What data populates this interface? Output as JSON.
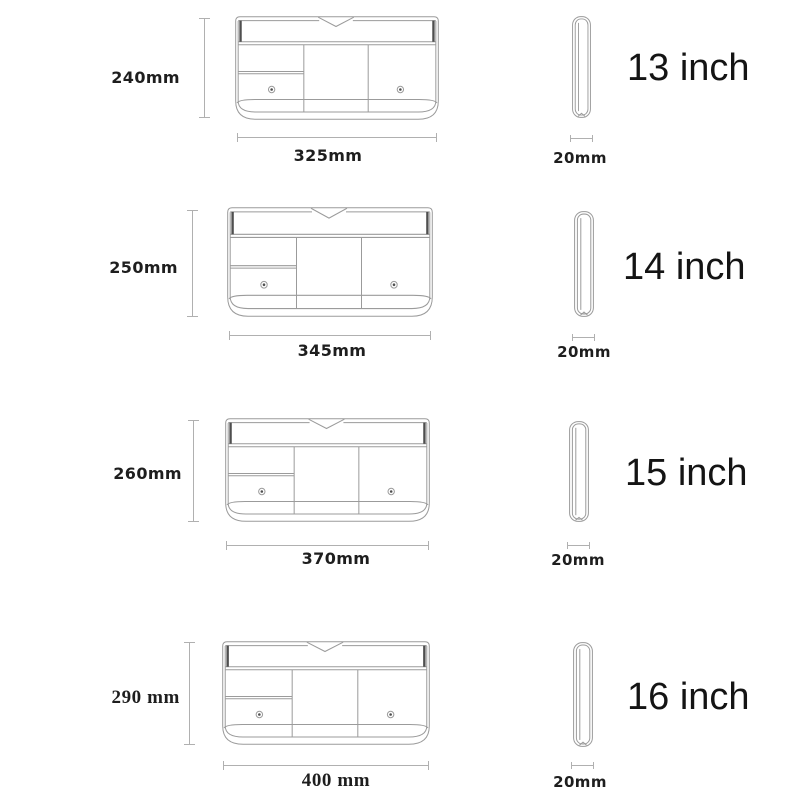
{
  "colors": {
    "background": "#ffffff",
    "ink": "#1e1e1e",
    "dim-line": "#b0b0b0",
    "drawing-line": "#9b9b9b",
    "drawing-dark": "#4f4f4f"
  },
  "rows": [
    {
      "size_label": "13 inch",
      "height_label": "240mm",
      "width_label": "325mm",
      "depth_label": "20mm"
    },
    {
      "size_label": "14 inch",
      "height_label": "250mm",
      "width_label": "345mm",
      "depth_label": "20mm"
    },
    {
      "size_label": "15 inch",
      "height_label": "260mm",
      "width_label": "370mm",
      "depth_label": "20mm"
    },
    {
      "size_label": "16 inch",
      "height_label": "290 mm",
      "width_label": "400 mm",
      "depth_label": "20mm"
    }
  ]
}
